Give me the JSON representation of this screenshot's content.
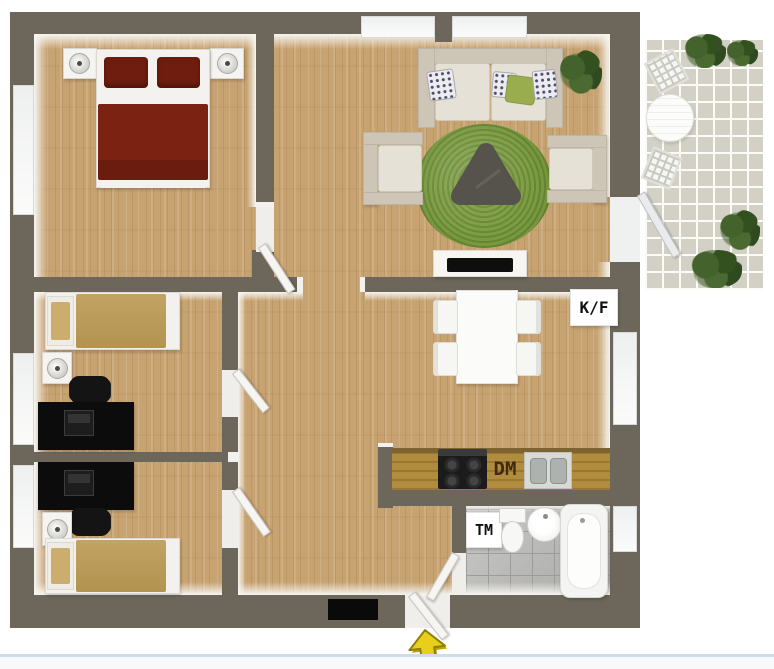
{
  "floorplan": {
    "labels": {
      "fridge_freezer": "K/F",
      "dishwasher": "DM",
      "washing_machine": "TM"
    },
    "icons": {
      "entrance": "yellow-up-arrow"
    },
    "colors": {
      "wall": "#6d675b",
      "floor_wood": "#c8a372",
      "counter_wood": "#b08c3e",
      "bed_double_blanket": "#7c2212",
      "bed_double_pillow": "#6f1d0e",
      "bed_single_blanket": "#c2a363",
      "rug_green": "#7c9c40",
      "coffee_table": "#55534b",
      "sofa_beige": "#cdc6b6",
      "cushion_light": "#e6e1d6",
      "pillow_green": "#9aad4e",
      "desk_black": "#0c0c0c",
      "patio_tile": "#d3d1c5",
      "bath_tile": "#b4b4b2",
      "plant_green": "#3c5a28",
      "arrow_yellow": "#e8d01a",
      "doormat_black": "#0a0a0a",
      "fixture_white": "#f7f7f5",
      "bottom_line_blue": "#cfdde9"
    }
  }
}
